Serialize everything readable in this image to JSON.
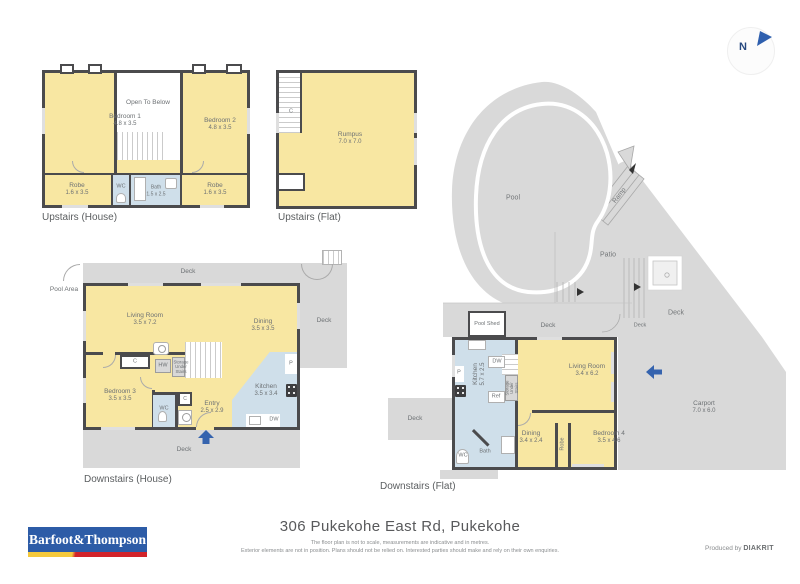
{
  "colors": {
    "wall": "#4b4b4d",
    "yellow": "#f8e7a2",
    "blue": "#cfdfea",
    "gray": "#d9d9d9",
    "accent": "#3563ae",
    "label": "#6d7174"
  },
  "compass": {
    "n": "N"
  },
  "site": {
    "pool": "Pool",
    "ramp": "Ramp",
    "patio": "Patio",
    "deck_right": "Deck",
    "deck_strip": "Deck",
    "deck_door": "Deck",
    "pool_shed": "Pool Shed"
  },
  "upstairs_house": {
    "title": "Upstairs (House)",
    "bedroom1": {
      "name": "Bedroom 1",
      "dims": "4.8 x 3.5"
    },
    "bedroom2": {
      "name": "Bedroom 2",
      "dims": "4.8 x 3.5"
    },
    "open_below": "Open To Below",
    "robe_left": {
      "name": "Robe",
      "dims": "1.6 x 3.5"
    },
    "robe_right": {
      "name": "Robe",
      "dims": "1.6 x 3.5"
    },
    "wc": "WC",
    "bath": {
      "name": "Bath",
      "dims": "1.5 x 2.5"
    }
  },
  "upstairs_flat": {
    "title": "Upstairs (Flat)",
    "rumpus": {
      "name": "Rumpus",
      "dims": "7.0 x 7.0"
    },
    "closet": "C"
  },
  "downstairs_house": {
    "title": "Downstairs (House)",
    "pool_area": "Pool Area",
    "deck_top": "Deck",
    "deck_right": "Deck",
    "deck_bottom": "Deck",
    "living": {
      "name": "Living Room",
      "dims": "3.5 x 7.2"
    },
    "dining": {
      "name": "Dining",
      "dims": "3.5 x 3.5"
    },
    "bedroom3": {
      "name": "Bedroom 3",
      "dims": "3.5 x 3.5"
    },
    "entry": {
      "name": "Entry",
      "dims": "2.5 x 2.9"
    },
    "kitchen": {
      "name": "Kitchen",
      "dims": "3.5 x 3.4"
    },
    "wc": "WC",
    "closet": "C",
    "closet2": "C",
    "hw": "HW",
    "pantry": "P",
    "dw": "DW",
    "storage": "Storage Under Stairs"
  },
  "downstairs_flat": {
    "title": "Downstairs (Flat)",
    "deck_left": "Deck",
    "kitchen": {
      "name": "Kitchen",
      "dims": "5.7 x 2.5"
    },
    "living": {
      "name": "Living Room",
      "dims": "3.4 x 6.2"
    },
    "dining": {
      "name": "Dining",
      "dims": "3.4 x 2.4"
    },
    "bedroom4": {
      "name": "Bedroom 4",
      "dims": "3.5 x 4.6"
    },
    "robe": "Robe",
    "bath": "Bath",
    "wc": "WC",
    "dw": "DW",
    "ref": "Ref",
    "pantry": "P",
    "storage": "Storage Under Stairs",
    "carport": {
      "name": "Carport",
      "dims": "7.0 x 6.0"
    }
  },
  "footer": {
    "address": "306 Pukekohe East Rd, Pukekohe",
    "disclaimer1": "The floor plan is not to scale, measurements are indicative and in metres.",
    "disclaimer2": "Exterior elements are not in position. Plans should not be relied on. Interested parties should make and rely on their own enquiries.",
    "produced_by": "Produced by",
    "producer": "DIAKRIT",
    "agency": "Barfoot&Thompson"
  }
}
